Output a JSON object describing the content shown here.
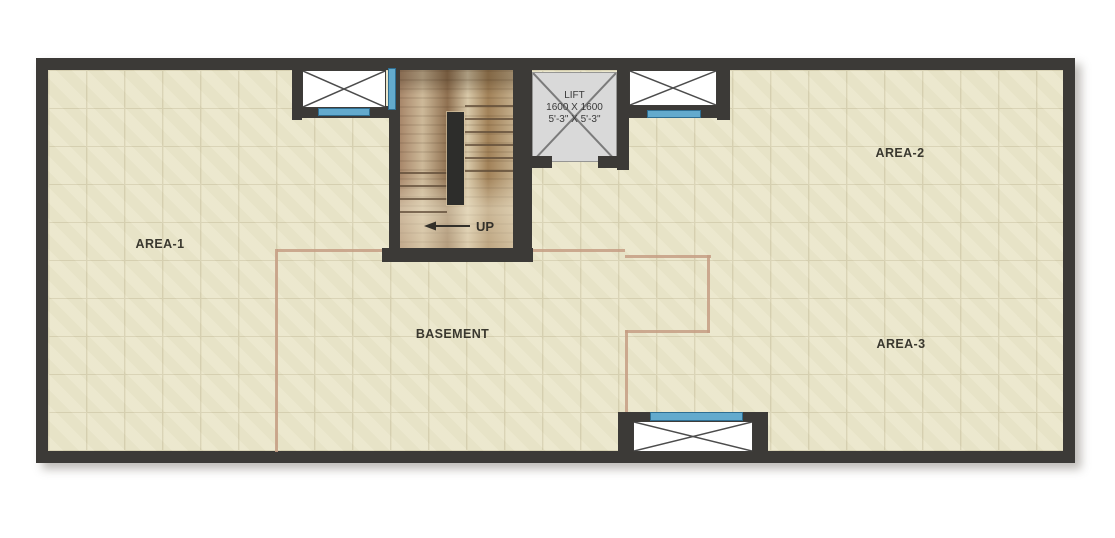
{
  "floor_plan": {
    "areas": {
      "area1": "AREA-1",
      "area2": "AREA-2",
      "area3": "AREA-3",
      "basement": "BASEMENT"
    },
    "stairs": {
      "up_label": "UP"
    },
    "lift": {
      "name": "LIFT",
      "dimensions_mm": "1600 X 1600",
      "dimensions_ft": "5'-3\" X 5'-3\""
    },
    "colors": {
      "wall": "#3c3a37",
      "floor": "#ebe7cc",
      "tile_line": "#d8d2b3",
      "glass": "#63aacd",
      "glass_edge": "#2e6e92",
      "lift_fill": "#d9d9d9",
      "lift_line": "#7b7b7b",
      "boundary": "#c69e84",
      "wood_dark": "#8a6c4d",
      "wood_light": "#d8c7a5",
      "stair_void": "#2d2d2b",
      "label_text": "#3a382f"
    }
  }
}
